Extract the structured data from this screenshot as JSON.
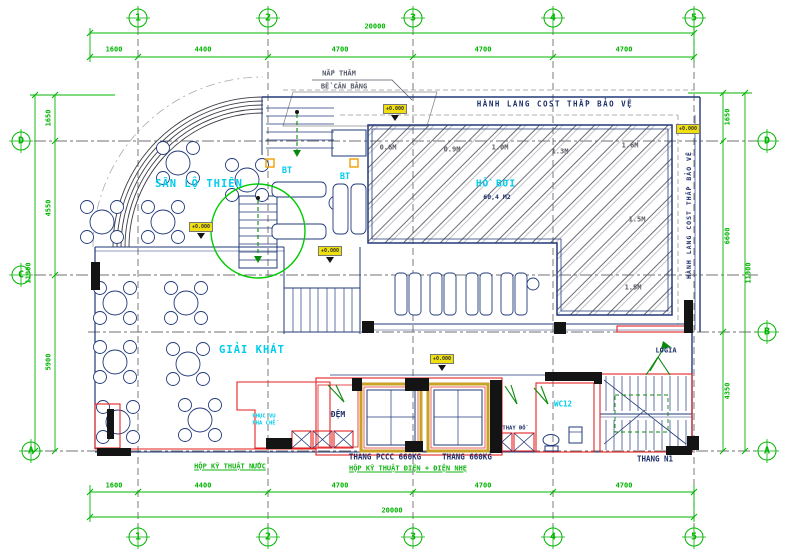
{
  "drawing": {
    "grid": {
      "cols": [
        "1",
        "2",
        "3",
        "4",
        "5"
      ],
      "left_rows": [
        "D",
        "C",
        "A"
      ],
      "right_rows": [
        "D",
        "B",
        "A"
      ]
    },
    "dims": {
      "top": {
        "total": "20000",
        "segments": [
          "1600",
          "4400",
          "4700",
          "4700",
          "4700"
        ]
      },
      "bottom": {
        "total": "20000",
        "segments": [
          "1600",
          "4400",
          "4700",
          "4700",
          "4700"
        ]
      },
      "left": {
        "total": "11900",
        "segments": [
          "1650",
          "4550",
          "5900"
        ]
      },
      "right": {
        "total": "11900",
        "segments": [
          "1650",
          "6600",
          "4350"
        ]
      }
    },
    "labels": {
      "nap_tham_line1": "NẮP THĂM",
      "nap_tham_line2": "BỂ CÂN BẰNG",
      "hanh_lang_top": "HÀNH LANG COST THẤP  BẢO VỆ",
      "hanh_lang_right": "HÀNH LANG COST THẤP  BẢO VỆ",
      "ho_boi": "HỒ BƠI",
      "ho_boi_area": "60,4 M2",
      "san_lo_thien": "SÂN LỘ THIÊN",
      "giai_khat": "GIẢI KHÁT",
      "bt1": "BT",
      "bt2": "BT",
      "logia": "LOGIA",
      "dem": "ĐỆM",
      "wc": "WC12",
      "thay_do": "THAY ĐỒ",
      "thang_n1": "THANG N1",
      "thang_pccc": "THANG PCCC 660KG",
      "thang_2": "THANG 660KG",
      "hop_nuoc": "HỘP KỸ THUẬT NƯỚC",
      "hop_dien": "HỘP KỸ THUẬT ĐIỆN + ĐIỆN NHẸ",
      "phuc_vu_line1": "PHỤC VỤ",
      "phuc_vu_line2": "PHA CHẾ"
    },
    "pool_depths": {
      "d1": "0.6M",
      "d2": "0.9M",
      "d3": "1.0M",
      "d4": "1.3M",
      "d5": "1.6M",
      "d6": "1.5M",
      "d7": "1.5M"
    },
    "elevation_tags": {
      "t1": "+0.000",
      "t2": "+0.000",
      "t3": "+0.000",
      "t4": "+0.000",
      "t5": "+0.000"
    },
    "colors": {
      "dim_green": "#00b400",
      "label_cyan": "#00ccee",
      "navy": "#1d2f6b",
      "wall_red": "#e42222",
      "tag_yellow": "#f0e010"
    }
  }
}
